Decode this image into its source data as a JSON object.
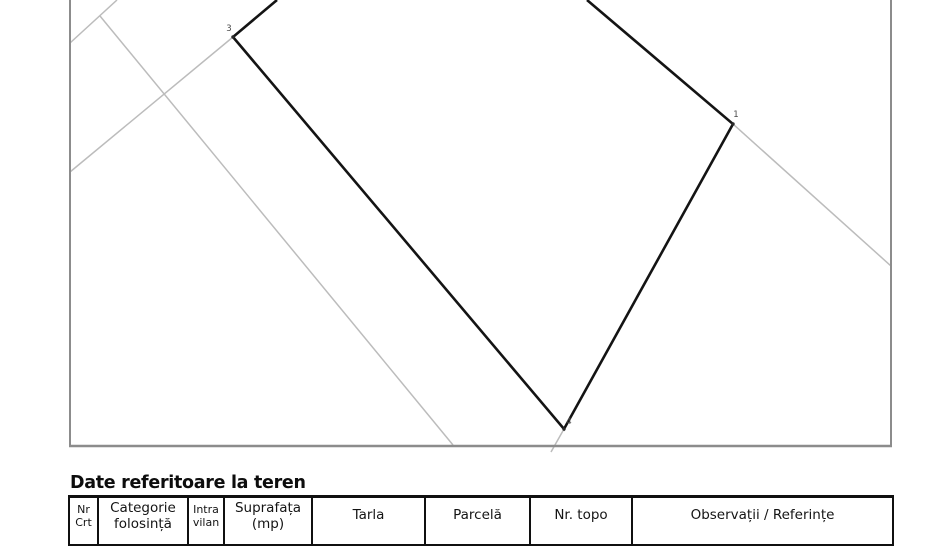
{
  "document": {
    "section_title": "Date referitoare la teren"
  },
  "map": {
    "colors": {
      "parcel_line": "#141414",
      "neighbor_line": "#bcbcbc",
      "frame_border": "#8c8c8c",
      "vertex_label": "#4a4a4a",
      "vertex_dot": "#2a2a2a"
    },
    "frame": {
      "left": 70,
      "right": 891,
      "top": 0,
      "bottom": 446
    },
    "parcel_boundary": {
      "points": [
        [
          277,
          0
        ],
        [
          233,
          37
        ],
        [
          564,
          429
        ],
        [
          733,
          124
        ],
        [
          587,
          0
        ]
      ]
    },
    "vertices": [
      {
        "label": "3",
        "x": 233,
        "y": 37,
        "lx": 229,
        "ly": 31
      },
      {
        "label": "4",
        "x": 564,
        "y": 429,
        "lx": 569,
        "ly": 424
      },
      {
        "label": "1",
        "x": 733,
        "y": 124,
        "lx": 736,
        "ly": 117
      }
    ],
    "neighbor_segments": [
      [
        [
          117,
          0
        ],
        [
          70,
          43
        ]
      ],
      [
        [
          100,
          16
        ],
        [
          453,
          445
        ]
      ],
      [
        [
          70,
          172
        ],
        [
          233,
          37
        ]
      ],
      [
        [
          733,
          124
        ],
        [
          891,
          266
        ]
      ],
      [
        [
          564,
          429
        ],
        [
          551,
          452
        ]
      ]
    ]
  },
  "table": {
    "columns": [
      {
        "label_line1": "Nr",
        "label_line2": "Crt"
      },
      {
        "label_line1": "Categorie",
        "label_line2": "folosință"
      },
      {
        "label_line1": "Intra",
        "label_line2": "vilan"
      },
      {
        "label_line1": "Suprafața",
        "label_line2": "(mp)"
      },
      {
        "label_line1": "Tarla"
      },
      {
        "label_line1": "Parcelă"
      },
      {
        "label_line1": "Nr. topo"
      },
      {
        "label_line1": "Observații / Referințe"
      }
    ]
  }
}
